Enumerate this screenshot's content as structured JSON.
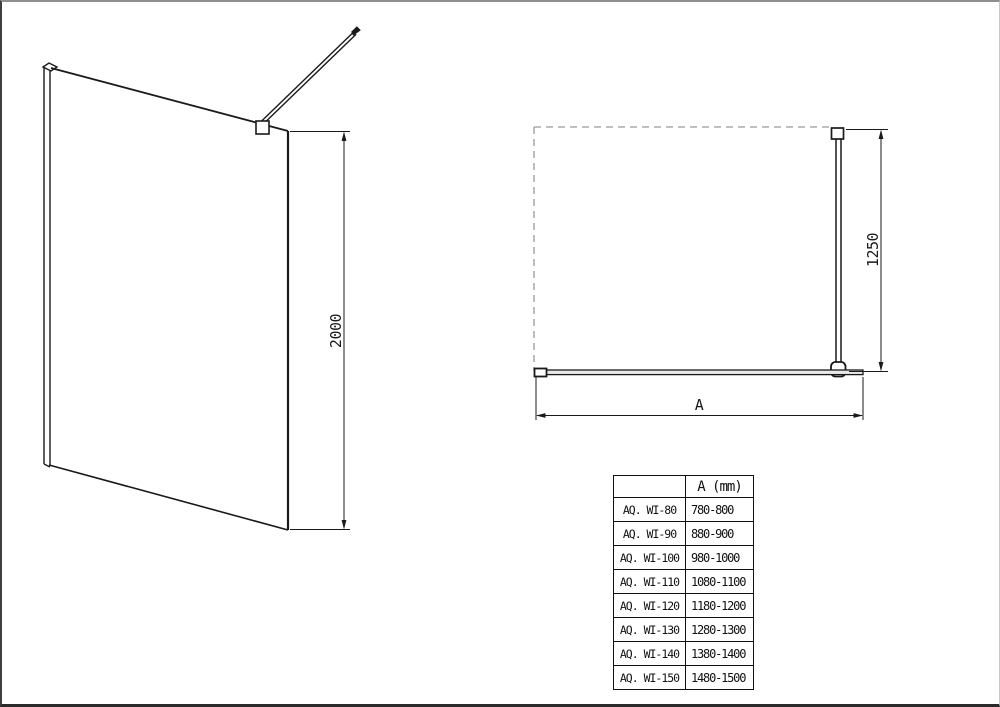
{
  "views": {
    "perspective": {
      "description": "walk-in shower glass panel with wall profile and support bar",
      "height_dimension": "2000"
    },
    "plan": {
      "description": "top view with dashed shower area outline, glass panel and support bar",
      "depth_dimension": "1250",
      "width_dimension_label": "A"
    }
  },
  "table": {
    "header": [
      "",
      "A (mm)"
    ],
    "rows": [
      [
        "AQ. WI-80",
        "780-800"
      ],
      [
        "AQ. WI-90",
        "880-900"
      ],
      [
        "AQ. WI-100",
        "980-1000"
      ],
      [
        "AQ. WI-110",
        "1080-1100"
      ],
      [
        "AQ. WI-120",
        "1180-1200"
      ],
      [
        "AQ. WI-130",
        "1280-1300"
      ],
      [
        "AQ. WI-140",
        "1380-1400"
      ],
      [
        "AQ. WI-150",
        "1480-1500"
      ]
    ]
  },
  "colors": {
    "line": "#1a1a1a",
    "dashed_outline": "#9a9a9a",
    "background": "#ffffff",
    "frame_top": "#8f8f8f",
    "frame_left": "#3f3f3f",
    "frame_bottom": "#2b2b2b",
    "frame_right": "#c9c9c9"
  }
}
